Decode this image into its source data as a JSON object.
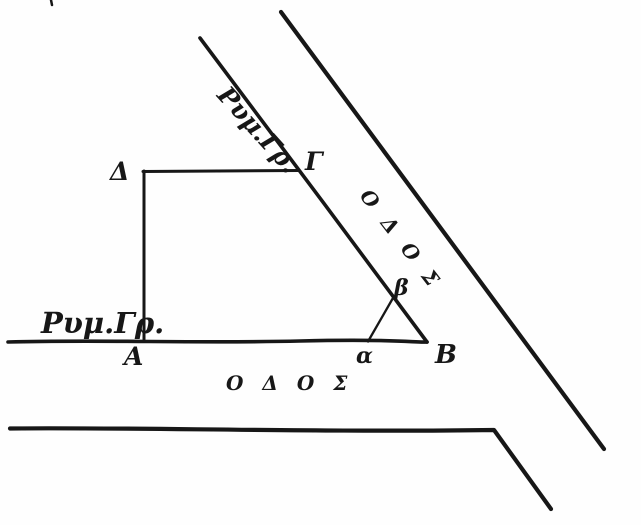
{
  "canvas": {
    "background": "#fefefe",
    "ink_color": "#171717"
  },
  "labels": {
    "plot_corner_delta": "Δ",
    "plot_corner_gamma": "Γ",
    "plot_corner_alpha": "Α",
    "plot_corner_beta": "Β",
    "aux_point_alpha": "α",
    "aux_point_beta": "β",
    "building_line_diagonal": "Ρυμ.Γρ.",
    "building_line_horizontal": "Ρυμ.Γρ.",
    "road_name_diagonal": "Ο Δ Ο Σ",
    "road_name_horizontal": "Ο Δ Ο Σ"
  }
}
